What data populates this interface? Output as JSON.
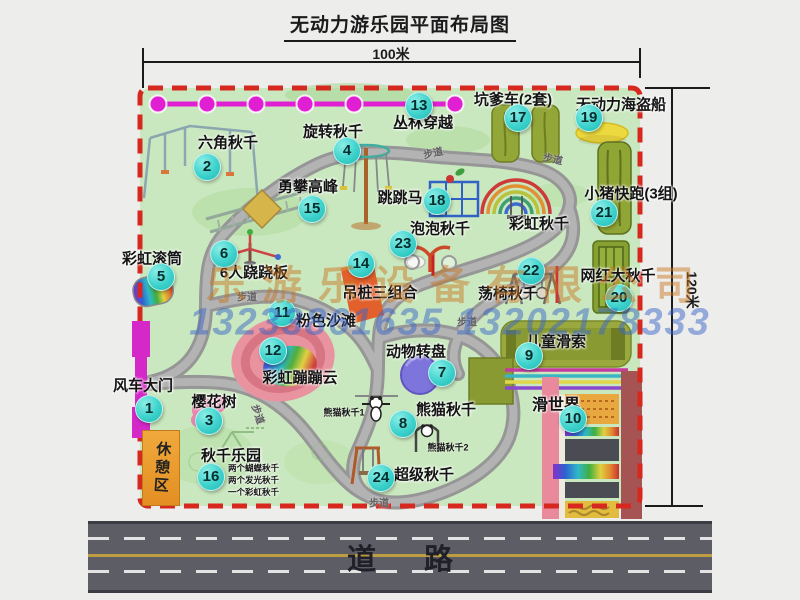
{
  "title": "无动力游乐园平面布局图",
  "dimensions": {
    "top": "100米",
    "right": "120米"
  },
  "road": {
    "label": "道路"
  },
  "watermark": {
    "company": "乐游乐设备有限公司",
    "phone": "13233861635 13202178333"
  },
  "walkway_label": "步道",
  "rest_area_label": "休憩区",
  "rainbow_swing_label": "彩虹秋千",
  "panda_sub_labels": [
    "熊猫秋千1",
    "熊猫秋千2"
  ],
  "swing_park_notes": [
    "两个蝴蝶秋千",
    "两个发光秋千",
    "一个彩虹秋千"
  ],
  "attractions": [
    {
      "num": "1",
      "label": "风车大门"
    },
    {
      "num": "2",
      "label": "六角秋千"
    },
    {
      "num": "3",
      "label": "樱花树"
    },
    {
      "num": "4",
      "label": "旋转秋千"
    },
    {
      "num": "5",
      "label": "彩虹滚筒"
    },
    {
      "num": "6",
      "label": "6人跷跷板"
    },
    {
      "num": "7",
      "label": "动物转盘"
    },
    {
      "num": "8",
      "label": "熊猫秋千"
    },
    {
      "num": "9",
      "label": "儿童滑索"
    },
    {
      "num": "10",
      "label": "滑世界"
    },
    {
      "num": "11",
      "label": "粉色沙滩"
    },
    {
      "num": "12",
      "label": "彩虹蹦蹦云"
    },
    {
      "num": "13",
      "label": "丛林穿越"
    },
    {
      "num": "14",
      "label": "吊桩三组合"
    },
    {
      "num": "15",
      "label": "勇攀高峰"
    },
    {
      "num": "16",
      "label": "秋千乐园"
    },
    {
      "num": "17",
      "label": "坑爹车(2套)"
    },
    {
      "num": "18",
      "label": "跳跳马"
    },
    {
      "num": "19",
      "label": "无动力海盗船"
    },
    {
      "num": "20",
      "label": "网红大秋千"
    },
    {
      "num": "21",
      "label": "小猪快跑(3组)"
    },
    {
      "num": "22",
      "label": "荡椅秋千"
    },
    {
      "num": "23",
      "label": "泡泡秋千"
    },
    {
      "num": "24",
      "label": "超级秋千"
    }
  ],
  "colors": {
    "badge": "#3ed2cc",
    "border_dash": "#d6281e",
    "park_green": "#cae8bf",
    "zipline_magenta": "#e01ed2",
    "gate_magenta": "#d428c8",
    "rest_area_orange": "#e89a2e",
    "road_gray": "#5d5d65"
  }
}
